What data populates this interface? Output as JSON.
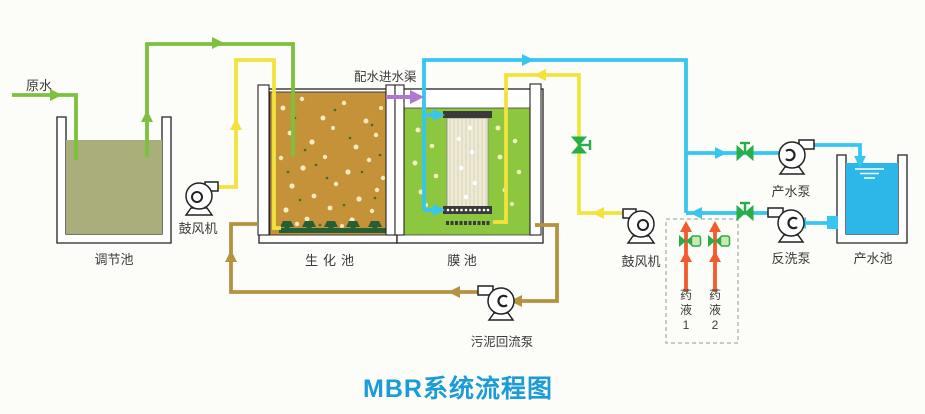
{
  "title": "MBR系统流程图",
  "labels": {
    "raw_water": "原水",
    "regulation_tank": "调节池",
    "blower_left": "鼓风机",
    "bio_tank": "生化池",
    "inlet_channel": "配水进水渠",
    "membrane_tank": "膜 池",
    "blower_right": "鼓风机",
    "product_pump": "产水泵",
    "backwash_pump": "反洗泵",
    "product_tank": "产水池",
    "sludge_pump": "污泥回流泵",
    "chemical_1": "药液1",
    "chemical_2": "药液2"
  },
  "icons": {
    "pump": "pump-icon",
    "blower": "blower-icon",
    "valve": "valve-icon",
    "chemical_valve": "actuated-valve-icon",
    "membrane_module": "membrane-module-icon",
    "diffuser": "diffuser-icon",
    "flow_arrow": "arrow-icon"
  },
  "colors": {
    "title_blue": "#1b9cd8",
    "pipe_green": "#7cc03e",
    "pipe_yellow": "#f2e33c",
    "pipe_cyan": "#36c6f0",
    "pipe_brown": "#b4923f",
    "arrow_purple": "#b077cf",
    "arrow_red": "#f15b2d",
    "valve_green": "#27ae49",
    "bio_tank_fill": "#c69239",
    "membrane_tank_fill": "#8dc63f",
    "regulation_water": "#a9ae7b",
    "product_water": "#2db6e8"
  }
}
